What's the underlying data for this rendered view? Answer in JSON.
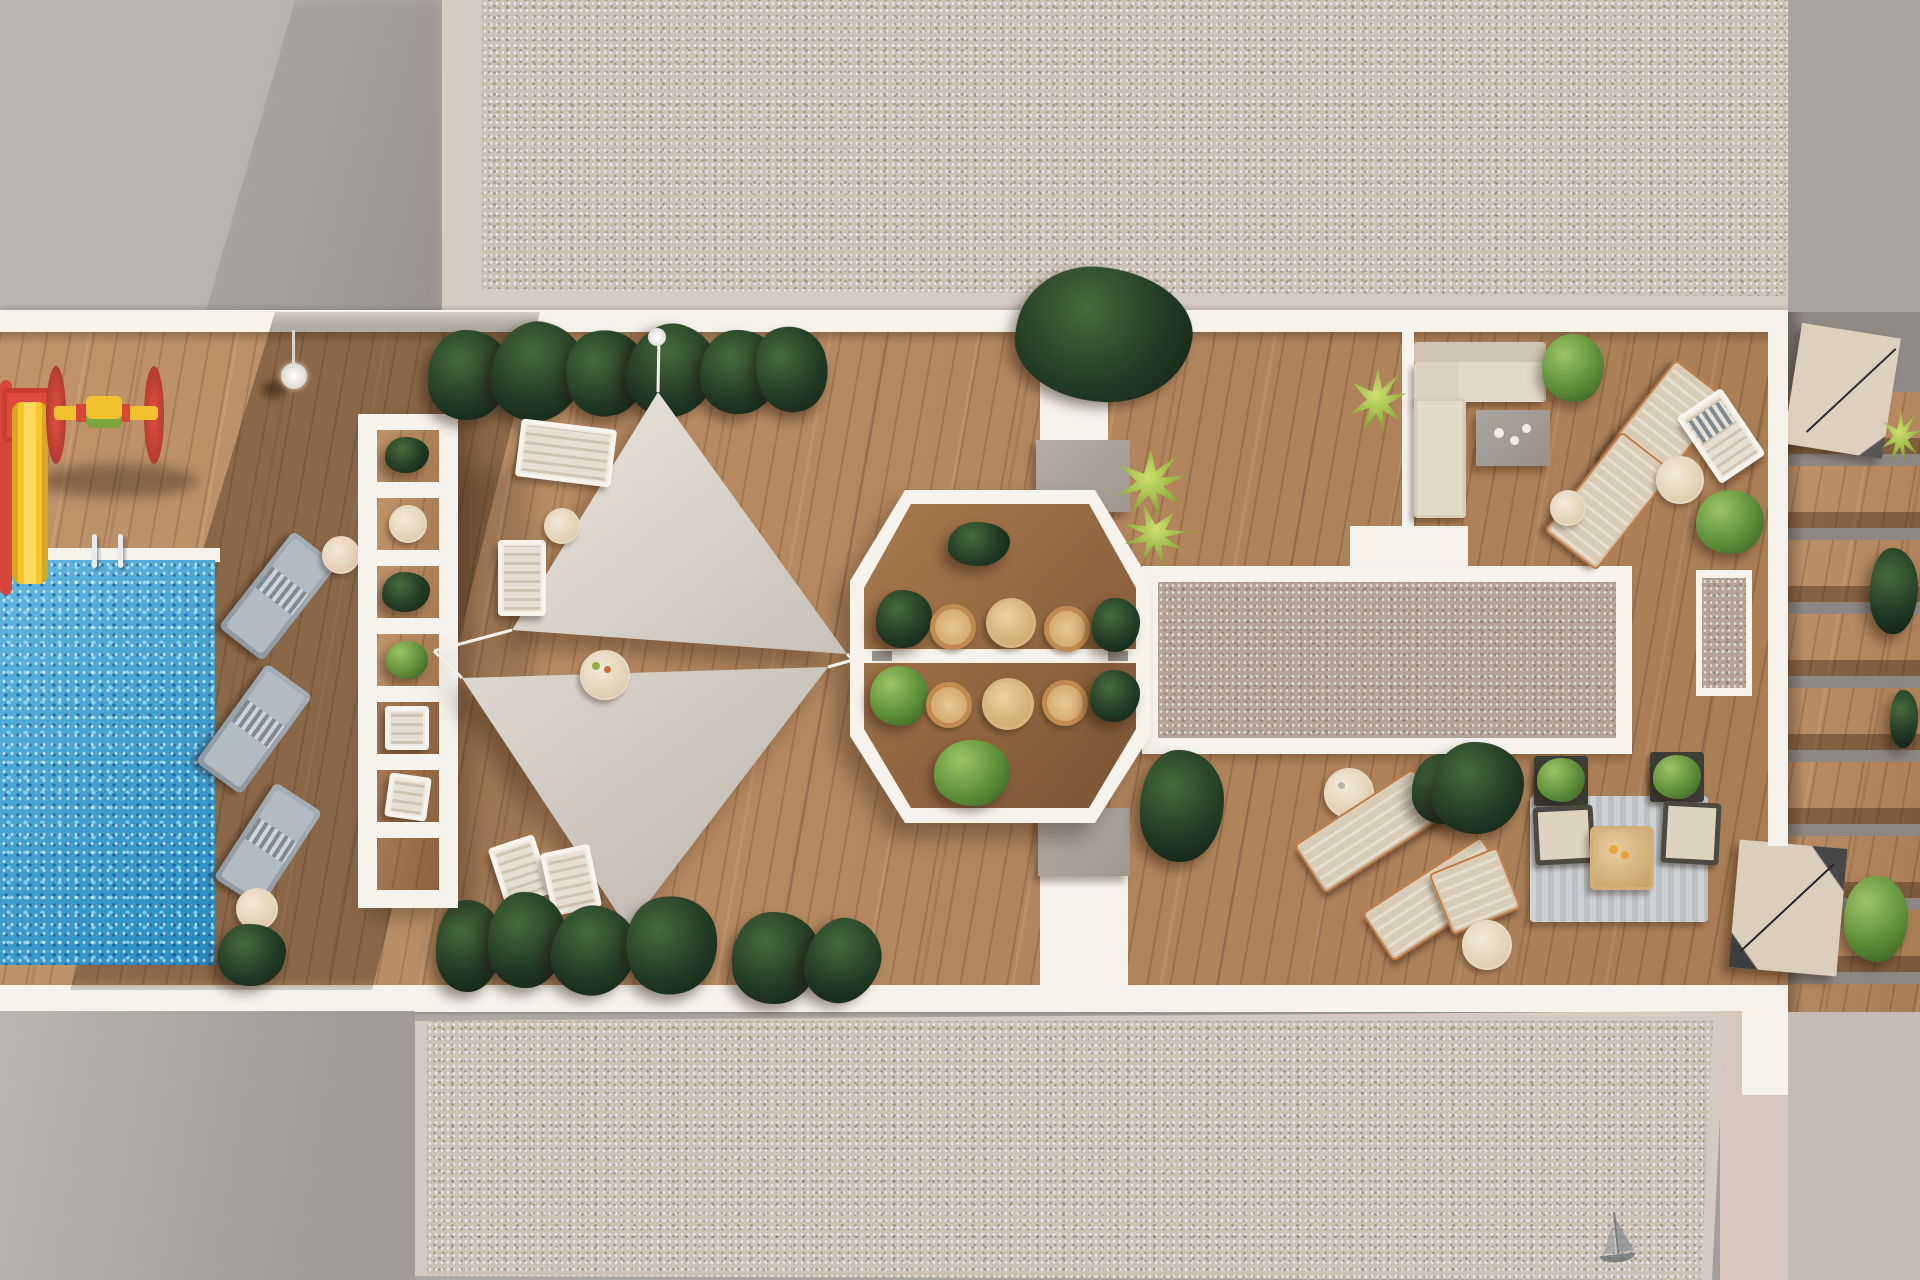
{
  "scene_type": "aerial 3D architectural rendering of a residential rooftop amenity terrace",
  "labels": {
    "canvas": "rooftop terrace aerial rendering",
    "pool": "swimming pool",
    "pool_ladder": "pool ladder",
    "playground": "children playground equipment",
    "slide": "yellow slide",
    "spinner": "red and yellow spinner toy",
    "pergola": "white pergola planter walkway",
    "shade_sails": "triangular shade sails",
    "octagon": "octagonal dining gazebo",
    "bistro_set": "bistro table with rattan chairs",
    "gravel_roof": "gravel roof slab",
    "gravel_court": "framed gravel court",
    "lounge_sofa": "L-shaped outdoor sofa",
    "coffee_table": "coffee table",
    "sunbed": "sun lounger",
    "side_table": "round side table",
    "rug_lounge": "outdoor rug seating set",
    "stairs": "rooftop stair unit",
    "walkway": "white walkway",
    "plant": "plant",
    "lamp": "terrace light",
    "sailboat_mark": "sailboat sketch on gravel"
  },
  "colors": {
    "gray-flat": "#b0aba7",
    "gray-dark": "#8f8a86",
    "white": "#f6f3ed",
    "gravel": "#cbc1b5",
    "gravel-mid": "#b3a496",
    "wood": "#b98a5e",
    "wood-dark": "#6e4f36",
    "oct-wood": "#9a6c45",
    "pool": "#2f9ed6",
    "sail": "#d9d4cb",
    "plant-dark": "#1d3320",
    "plant-bright": "#6f9c44",
    "yucca": "#9ab84a",
    "play-red": "#dd4639",
    "play-yellow": "#f3c32f",
    "lounger-gray": "#9aa3ab",
    "beige": "#d8cebb",
    "rattan": "#c08a50",
    "table-wood": "#d4ad78",
    "gray-box": "#a9a29a",
    "rug": "#c7cbcd",
    "copper": "#c07b43",
    "stairs-beige": "#dbceba",
    "wall": "#ddd2c4",
    "pink-paving": "#d9c6bc"
  }
}
